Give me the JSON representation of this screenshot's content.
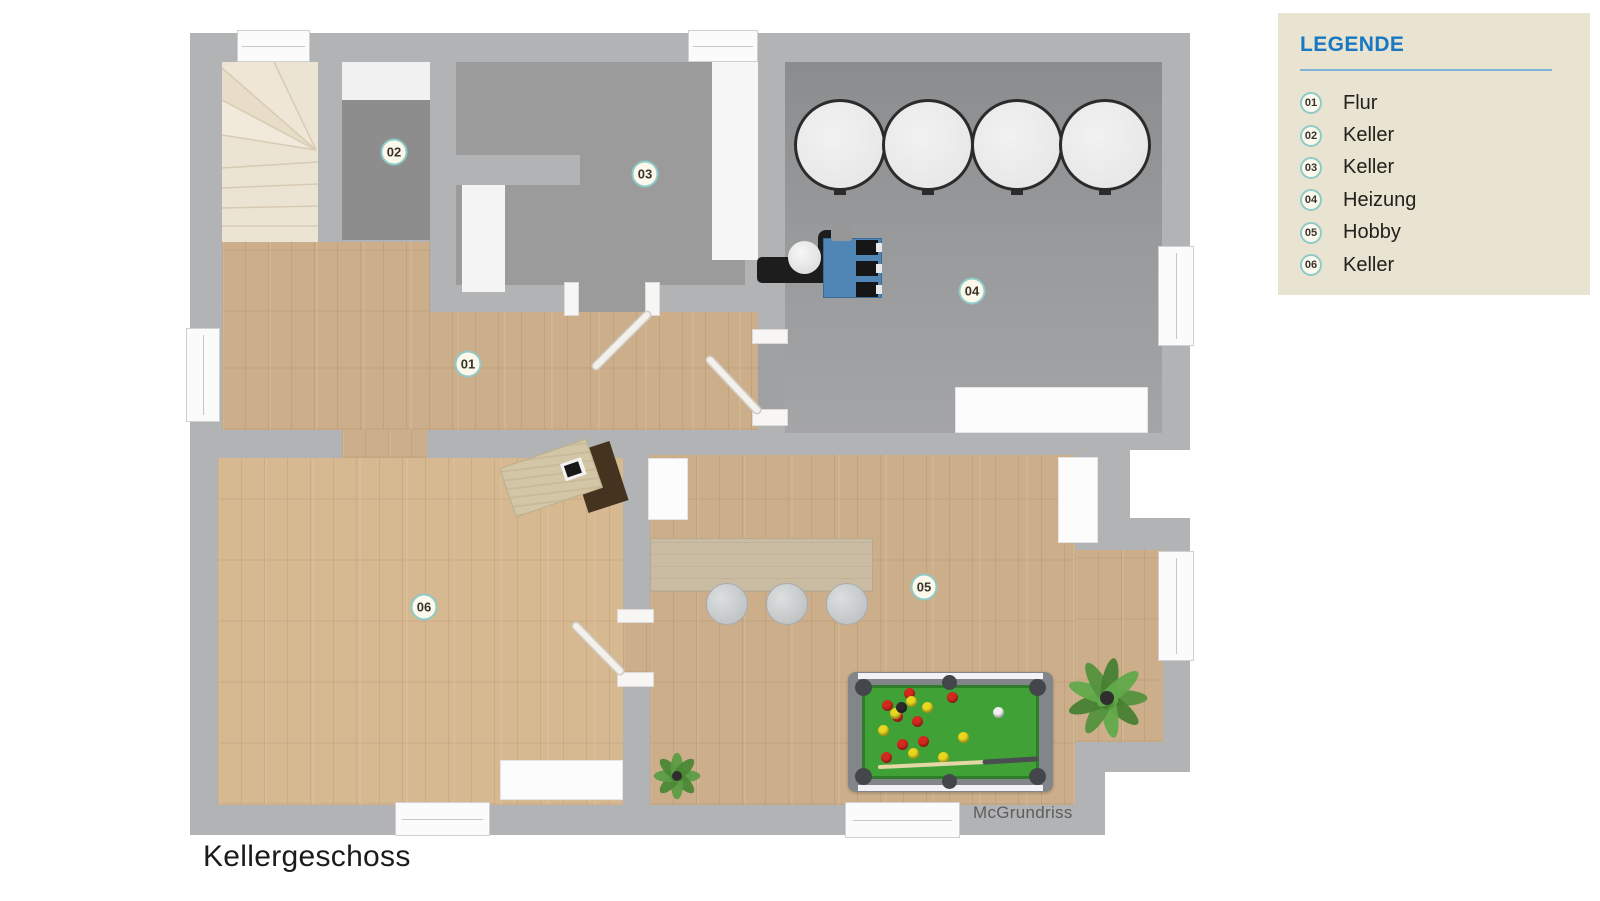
{
  "floor_title": "Kellergeschoss",
  "watermark": "McGrundriss",
  "legend": {
    "title": "LEGENDE",
    "items": [
      {
        "number": "01",
        "label": "Flur"
      },
      {
        "number": "02",
        "label": "Keller"
      },
      {
        "number": "03",
        "label": "Keller"
      },
      {
        "number": "04",
        "label": "Heizung"
      },
      {
        "number": "05",
        "label": "Hobby"
      },
      {
        "number": "06",
        "label": "Keller"
      }
    ]
  },
  "rooms": [
    {
      "number": "01",
      "name": "Flur",
      "x": 468,
      "y": 364
    },
    {
      "number": "02",
      "name": "Keller",
      "x": 394,
      "y": 152
    },
    {
      "number": "03",
      "name": "Keller",
      "x": 645,
      "y": 174
    },
    {
      "number": "04",
      "name": "Heizung",
      "x": 972,
      "y": 291
    },
    {
      "number": "05",
      "name": "Hobby",
      "x": 924,
      "y": 587
    },
    {
      "number": "06",
      "name": "Keller",
      "x": 424,
      "y": 607
    }
  ],
  "colors": {
    "legend_bg": "#e9e3d2",
    "accent_blue": "#1878c2",
    "badge_ring": "#8ecac8",
    "wall": "#b2b3b5",
    "wood_floor": "#ccaf8a",
    "concrete_floor": "#9b9b9b",
    "pool_felt": "#3fa136",
    "ball_red": "#d42a1e",
    "ball_yellow": "#e8d61f",
    "ball_black": "#2b2b2b",
    "ball_white": "#f2f2f2"
  },
  "pool_balls": [
    {
      "color": "red",
      "x": 887,
      "y": 705
    },
    {
      "color": "red",
      "x": 909,
      "y": 693
    },
    {
      "color": "red",
      "x": 897,
      "y": 716
    },
    {
      "color": "red",
      "x": 917,
      "y": 721
    },
    {
      "color": "red",
      "x": 902,
      "y": 744
    },
    {
      "color": "red",
      "x": 923,
      "y": 741
    },
    {
      "color": "red",
      "x": 952,
      "y": 697
    },
    {
      "color": "red",
      "x": 886,
      "y": 757
    },
    {
      "color": "yellow",
      "x": 883,
      "y": 730
    },
    {
      "color": "yellow",
      "x": 895,
      "y": 713
    },
    {
      "color": "yellow",
      "x": 911,
      "y": 701
    },
    {
      "color": "yellow",
      "x": 927,
      "y": 707
    },
    {
      "color": "yellow",
      "x": 963,
      "y": 737
    },
    {
      "color": "yellow",
      "x": 913,
      "y": 753
    },
    {
      "color": "yellow",
      "x": 943,
      "y": 757
    },
    {
      "color": "black",
      "x": 901,
      "y": 707
    },
    {
      "color": "white",
      "x": 998,
      "y": 712
    }
  ]
}
